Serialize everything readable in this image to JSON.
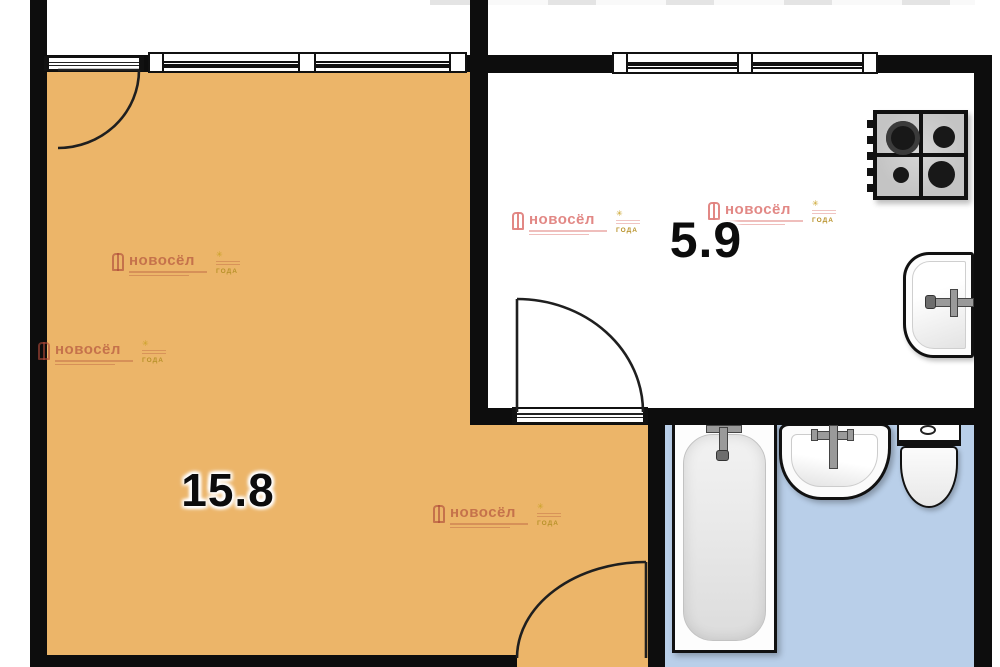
{
  "meta": {
    "type": "apartment-floor-plan"
  },
  "rooms": {
    "living": {
      "area_label": "15.8"
    },
    "kitchen": {
      "area_label": "5.9"
    }
  },
  "watermark": {
    "brand": "новосёл",
    "badge_text": "ГОДА"
  },
  "colors": {
    "wall": "#0d0d0d",
    "living_floor": "#ecb569",
    "bathroom_floor": "#b9cfe9",
    "kitchen_floor": "#ffffff",
    "watermark_pink": "#d88f85",
    "watermark_gold": "#c9a227",
    "fixture_gray": "#c9c9c9"
  }
}
